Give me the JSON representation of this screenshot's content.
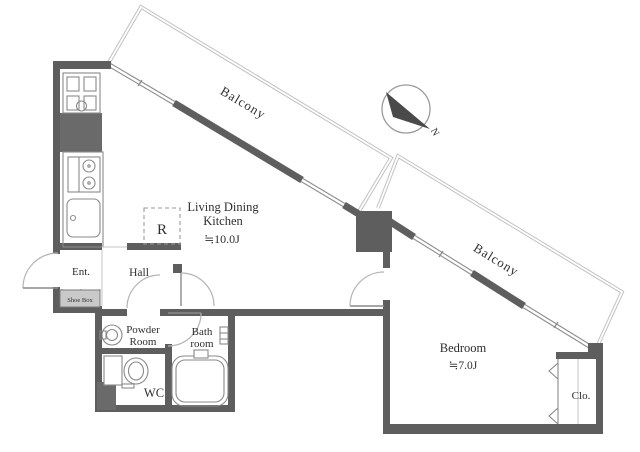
{
  "plan": {
    "type": "apartment-floor-plan",
    "colors": {
      "wall": "#5e5e5e",
      "window_line": "#8f8f8f",
      "balcony_line": "#c2c2c2",
      "text": "#2e2e2e",
      "background": "#ffffff"
    },
    "compass": {
      "north_label": "N"
    },
    "rooms": {
      "balcony1": {
        "label": "Balcony"
      },
      "balcony2": {
        "label": "Balcony"
      },
      "ldk": {
        "line1": "Living Dining",
        "line2": "Kitchen",
        "size": "≒10.0J"
      },
      "refrigerator": {
        "label": "R"
      },
      "entrance": {
        "label": "Ent."
      },
      "hall": {
        "label": "Hall"
      },
      "shoe_box": {
        "label": "Shoe Box"
      },
      "powder_room": {
        "line1": "Powder",
        "line2": "Room"
      },
      "bathroom": {
        "line1": "Bath",
        "line2": "room"
      },
      "wc": {
        "label": "WC"
      },
      "bedroom": {
        "label": "Bedroom",
        "size": "≒7.0J"
      },
      "closet": {
        "label": "Clo."
      }
    }
  }
}
